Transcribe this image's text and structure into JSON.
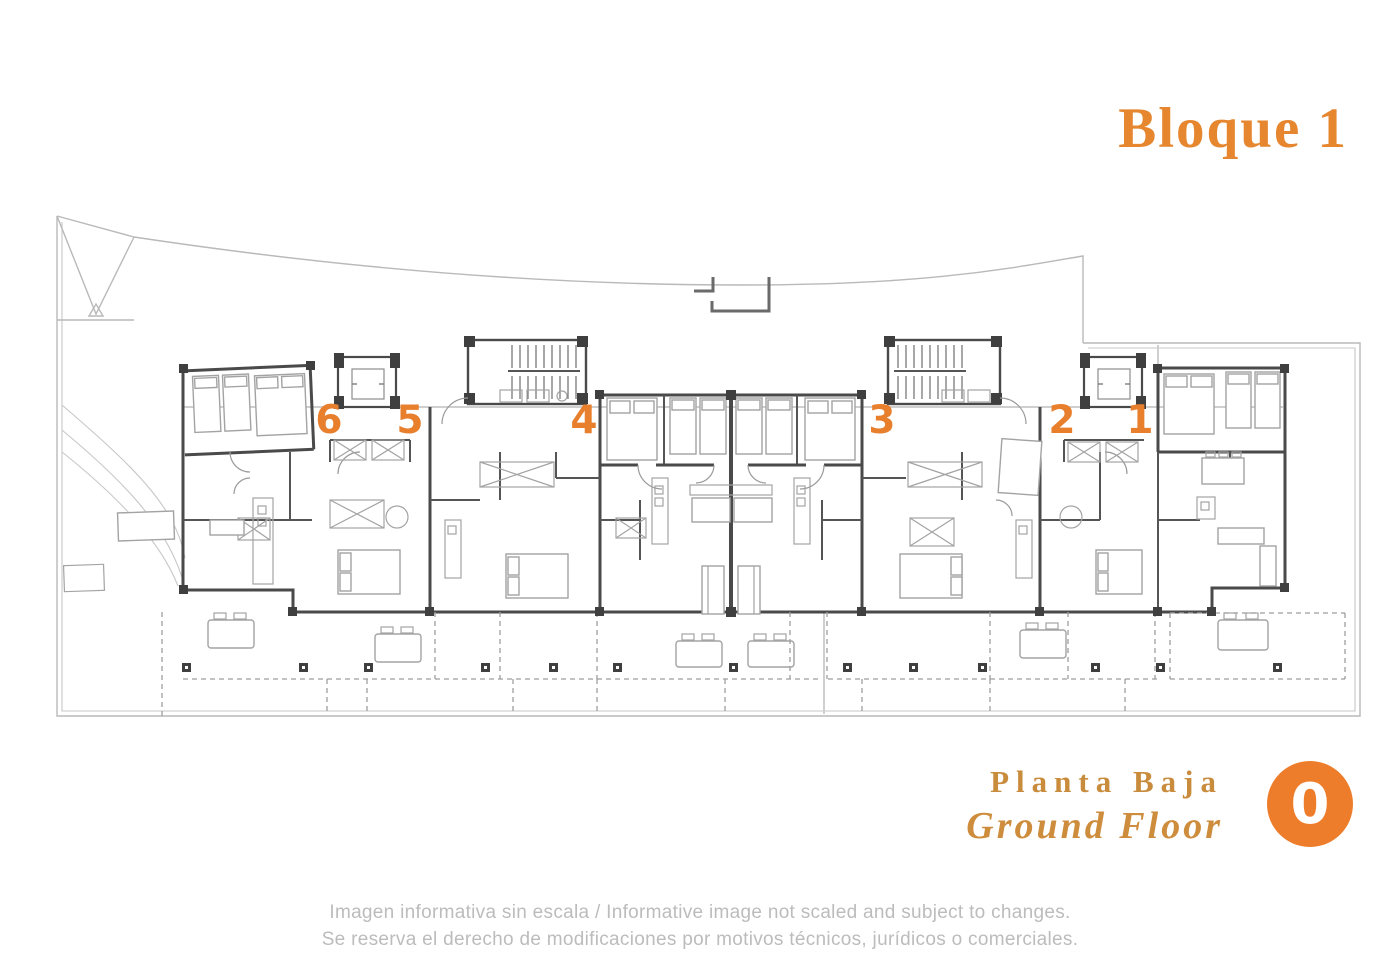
{
  "header": {
    "title": "Bloque 1"
  },
  "plan": {
    "units": [
      {
        "number": "6"
      },
      {
        "number": "5"
      },
      {
        "number": "4"
      },
      {
        "number": "3"
      },
      {
        "number": "2"
      },
      {
        "number": "1"
      }
    ]
  },
  "footer": {
    "floor_name_es": "Planta Baja",
    "floor_name_en": "Ground Floor",
    "badge": "0"
  },
  "disclaimer": {
    "line1": "Imagen informativa sin escala /  Informative image not scaled and subject to changes.",
    "line2": "Se reserva el derecho de modificaciones por motivos técnicos, jurídicos o comerciales."
  },
  "colors": {
    "accent_orange": "#E87F2D",
    "badge_orange": "#EE7D2B",
    "footer_gold": "#C98B3C",
    "wall_gray": "#4a4a4a",
    "boundary_gray": "#b9b9b9",
    "disclaimer_gray": "#bcbcbc"
  }
}
